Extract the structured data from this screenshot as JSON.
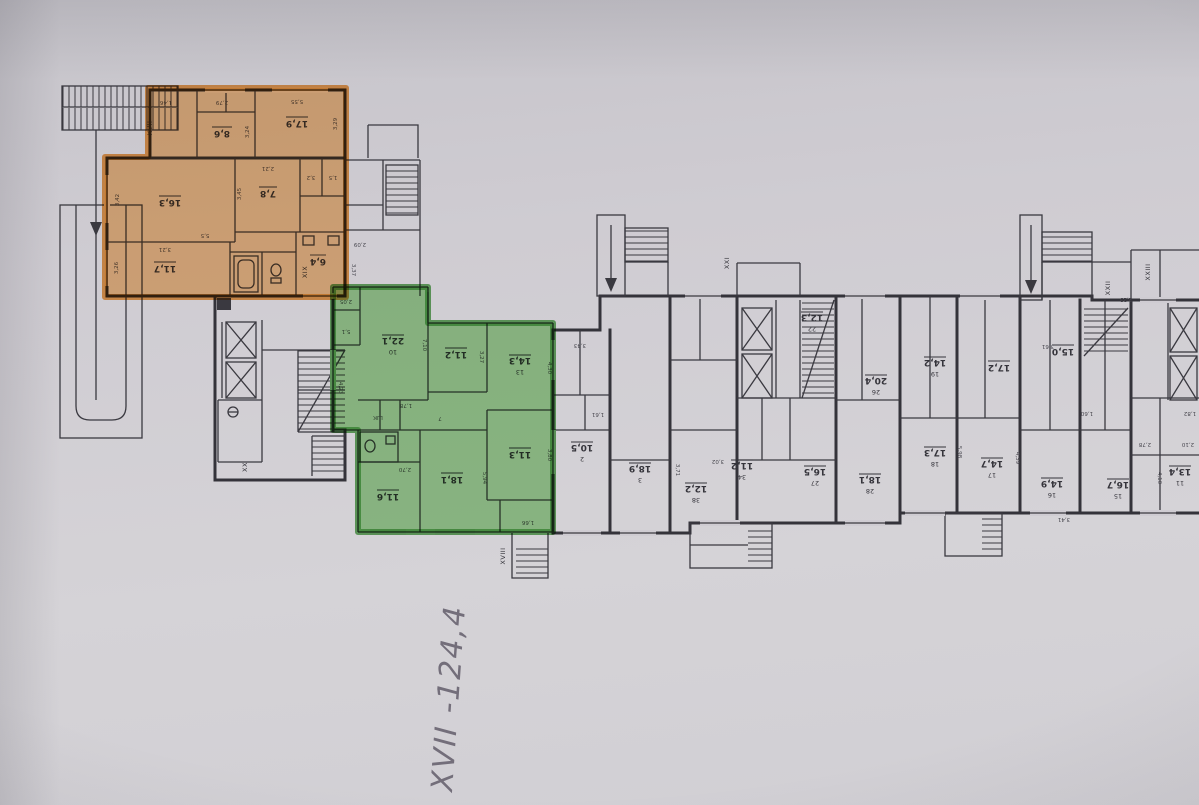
{
  "colors": {
    "paper": "#cfccd2",
    "ink": "#34333a",
    "orange_fill": "#f5a243",
    "orange_edge": "#ee8d2b",
    "green_fill": "#66c254",
    "green_edge": "#3c9a36",
    "pencil": "#6b6673"
  },
  "handwriting": {
    "text": "XVII -124,4"
  },
  "section_labels": {
    "xvii": "XVII",
    "xviii": "XVIII",
    "xix": "XIX",
    "xx": "XX",
    "xxi": "XXI",
    "xxii": "XXII",
    "xxiii": "XXIII"
  },
  "orange": {
    "rooms": [
      {
        "area": "8,6",
        "d1": "3,24",
        "d2": "2,79",
        "d3": "1,46"
      },
      {
        "area": "17,9",
        "d1": "5,55",
        "d2": "3,29"
      },
      {
        "area": "16,3",
        "d1": "3,42",
        "d2": "5,5"
      },
      {
        "area": "7,8",
        "d1": "3,45",
        "d2": "2,21"
      },
      {
        "area": "11,7",
        "d1": "3,26",
        "d2": "3,21"
      },
      {
        "area": "6,4"
      }
    ],
    "side_rooms": [
      {
        "area": "3,2"
      },
      {
        "area": "1,5"
      }
    ]
  },
  "green": {
    "rooms": [
      {
        "num": "10",
        "area": "22,1",
        "d1": "7,10"
      },
      {
        "area": "11,2",
        "d1": "3,27"
      },
      {
        "num": "13",
        "area": "14,3",
        "d1": "4,30"
      },
      {
        "area": "18,1",
        "d1": "5,94"
      },
      {
        "area": "11,6",
        "d1": "2,70"
      },
      {
        "area": "11,3",
        "d1": "3,80"
      },
      {
        "area": "5,1"
      },
      {
        "area": "2,05"
      }
    ],
    "corridor_area": "7",
    "closet_label": "ШК",
    "closet_d": "1,78",
    "bath_d": "1,66",
    "edge_d": "4,23"
  },
  "mid_rooms": [
    {
      "num": "2",
      "area": "10,5"
    },
    {
      "num": "3",
      "area": "18,9"
    },
    {
      "num": "38",
      "area": "12,2"
    },
    {
      "num": "34",
      "area": "11,2"
    },
    {
      "num": "27",
      "area": "16,5"
    },
    {
      "num": "28",
      "area": "18,1"
    },
    {
      "num": "22",
      "area": "12,3"
    },
    {
      "num": "26",
      "area": "20,4"
    },
    {
      "num": "19",
      "area": "14,2"
    },
    {
      "area": "15,0"
    },
    {
      "area": "17,2"
    }
  ],
  "right_rooms": [
    {
      "num": "18",
      "area": "17,3",
      "d": "5,98"
    },
    {
      "num": "17",
      "area": "14,7",
      "d": "4,39"
    },
    {
      "num": "16",
      "area": "14,9",
      "d": "3,41"
    },
    {
      "num": "15",
      "area": "16,7"
    },
    {
      "num": "11",
      "area": "13,4",
      "d": "4,10"
    }
  ],
  "dims": {
    "a": "3,43",
    "b": "1,61",
    "c": "2,09",
    "d": "3,37",
    "e": "3,61",
    "f": "2,23",
    "g": "1,60",
    "h": "1,82",
    "i": "2,78",
    "j": "2,10",
    "k": "3,71",
    "l": "3,02"
  }
}
